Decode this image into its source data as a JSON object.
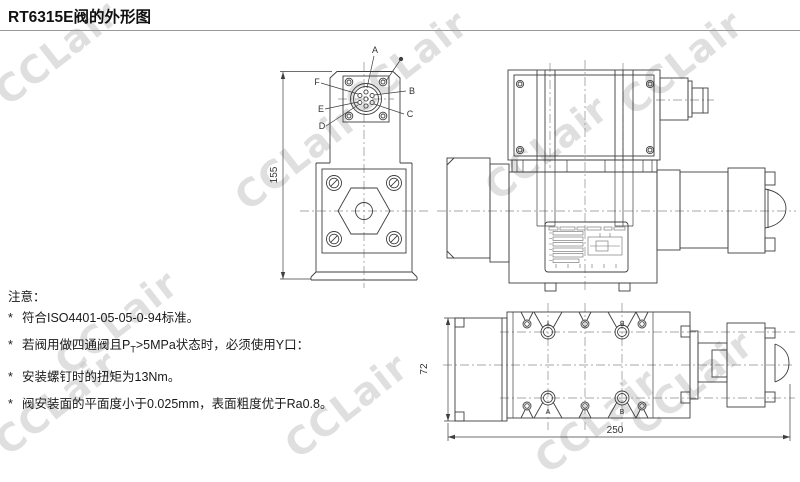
{
  "title": "RT6315E阀的外形图",
  "watermark": {
    "text": "CCLair"
  },
  "notes": {
    "heading": "注意：",
    "items": [
      {
        "bullet": "*",
        "text": "符合ISO4401-05-05-0-94标准。"
      },
      {
        "bullet": "*",
        "pre": "若阀用做四通阀且P",
        "sub": "T",
        "post": ">5MPa状态时，必须使用Y口："
      },
      {
        "bullet": "*",
        "text": "安装螺钉时的扭矩为13Nm。"
      },
      {
        "bullet": "*",
        "text": "阀安装面的平面度小于0.025mm，表面粗度优于Ra0.8。"
      }
    ]
  },
  "views": {
    "front": {
      "dim_height": "155",
      "pins": {
        "a": "A",
        "b": "B",
        "c": "C",
        "d": "D",
        "e": "E",
        "f": "F"
      }
    },
    "bottom": {
      "dim_depth": "72",
      "dim_length": "250",
      "ports": {
        "top_left": "Y",
        "top_right": "B",
        "bottom_left": "A",
        "bottom_right": "B"
      }
    }
  }
}
